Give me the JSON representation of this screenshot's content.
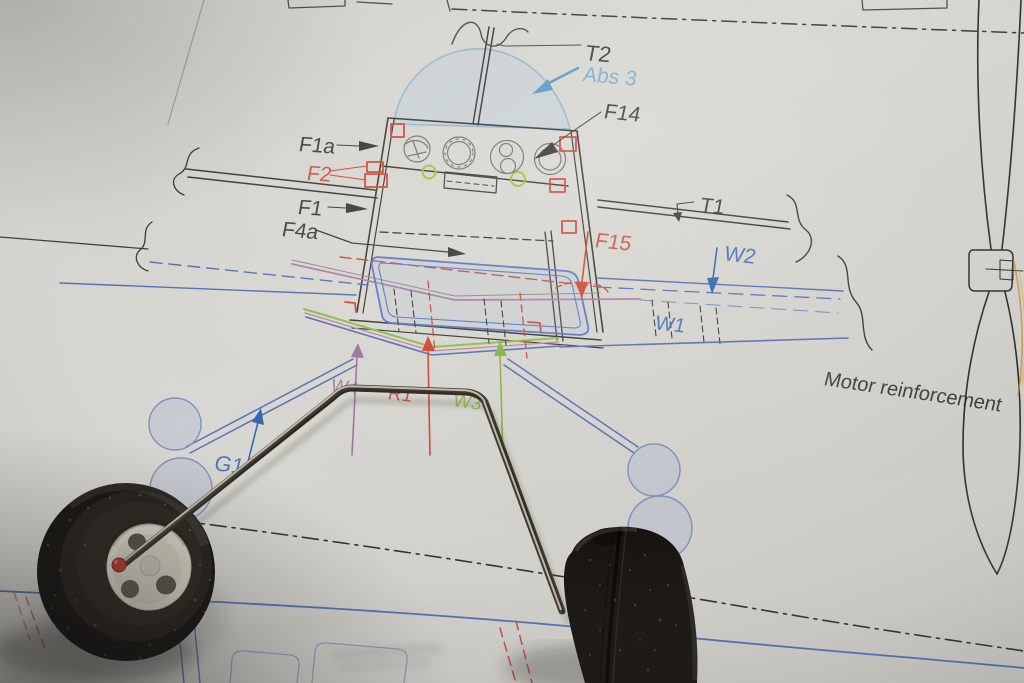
{
  "plan": {
    "labels": {
      "t2": "T2",
      "abs3": "Abs 3",
      "f14": "F14",
      "f1a": "F1a",
      "f2": "F2",
      "f1": "F1",
      "f4a": "F4a",
      "t1": "T1",
      "f15": "F15",
      "w2": "W2",
      "w1": "W1",
      "motor_reinforcement": "Motor reinforcement",
      "g1": "G1",
      "w4": "W4",
      "r1": "R1",
      "w3": "W3"
    },
    "colors": {
      "ink": "#2b2b28",
      "label_blue": "#3468b0",
      "label_light_blue": "#6ea9d4",
      "label_red": "#c64530",
      "label_purple": "#a0739f",
      "label_green": "#83b544",
      "plan_blue": "#5570b8",
      "canopy_blue": "#8fb8d2",
      "plan_red": "#cc4a33",
      "plan_green": "#8abf4a",
      "paper": "#d4d3ce"
    }
  }
}
